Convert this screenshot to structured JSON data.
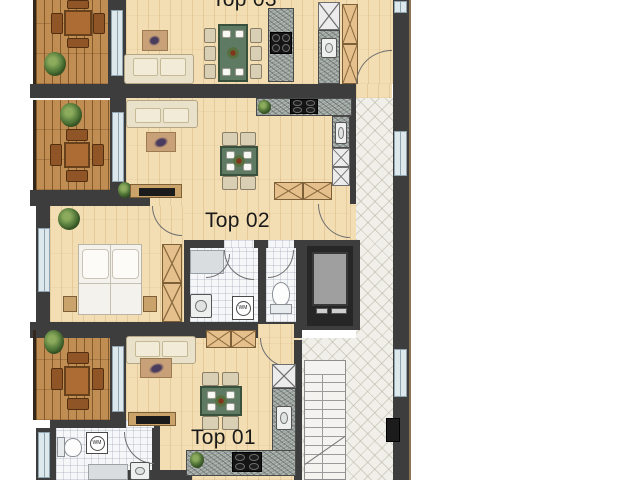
{
  "plan": {
    "units": [
      {
        "id": "top-01",
        "label": "Top 01"
      },
      {
        "id": "top-02",
        "label": "Top 02"
      },
      {
        "id": "top-03",
        "label": "Top 03"
      }
    ],
    "appliances": {
      "washing_machine_label": "WM"
    },
    "colors": {
      "wall": "#3d3d3d",
      "wood_floor": "#f3deb3",
      "balcony_deck": "#c08d52",
      "corridor_tile": "#f0efe9",
      "bathroom_tile": "#f6f7f9",
      "dining_table_green": "#5e7a62",
      "sofa_cream": "#eae1ca",
      "counter_granite": "#98a09c",
      "elevator_cab": "#9f9f9f",
      "background": "#ffffff"
    }
  }
}
